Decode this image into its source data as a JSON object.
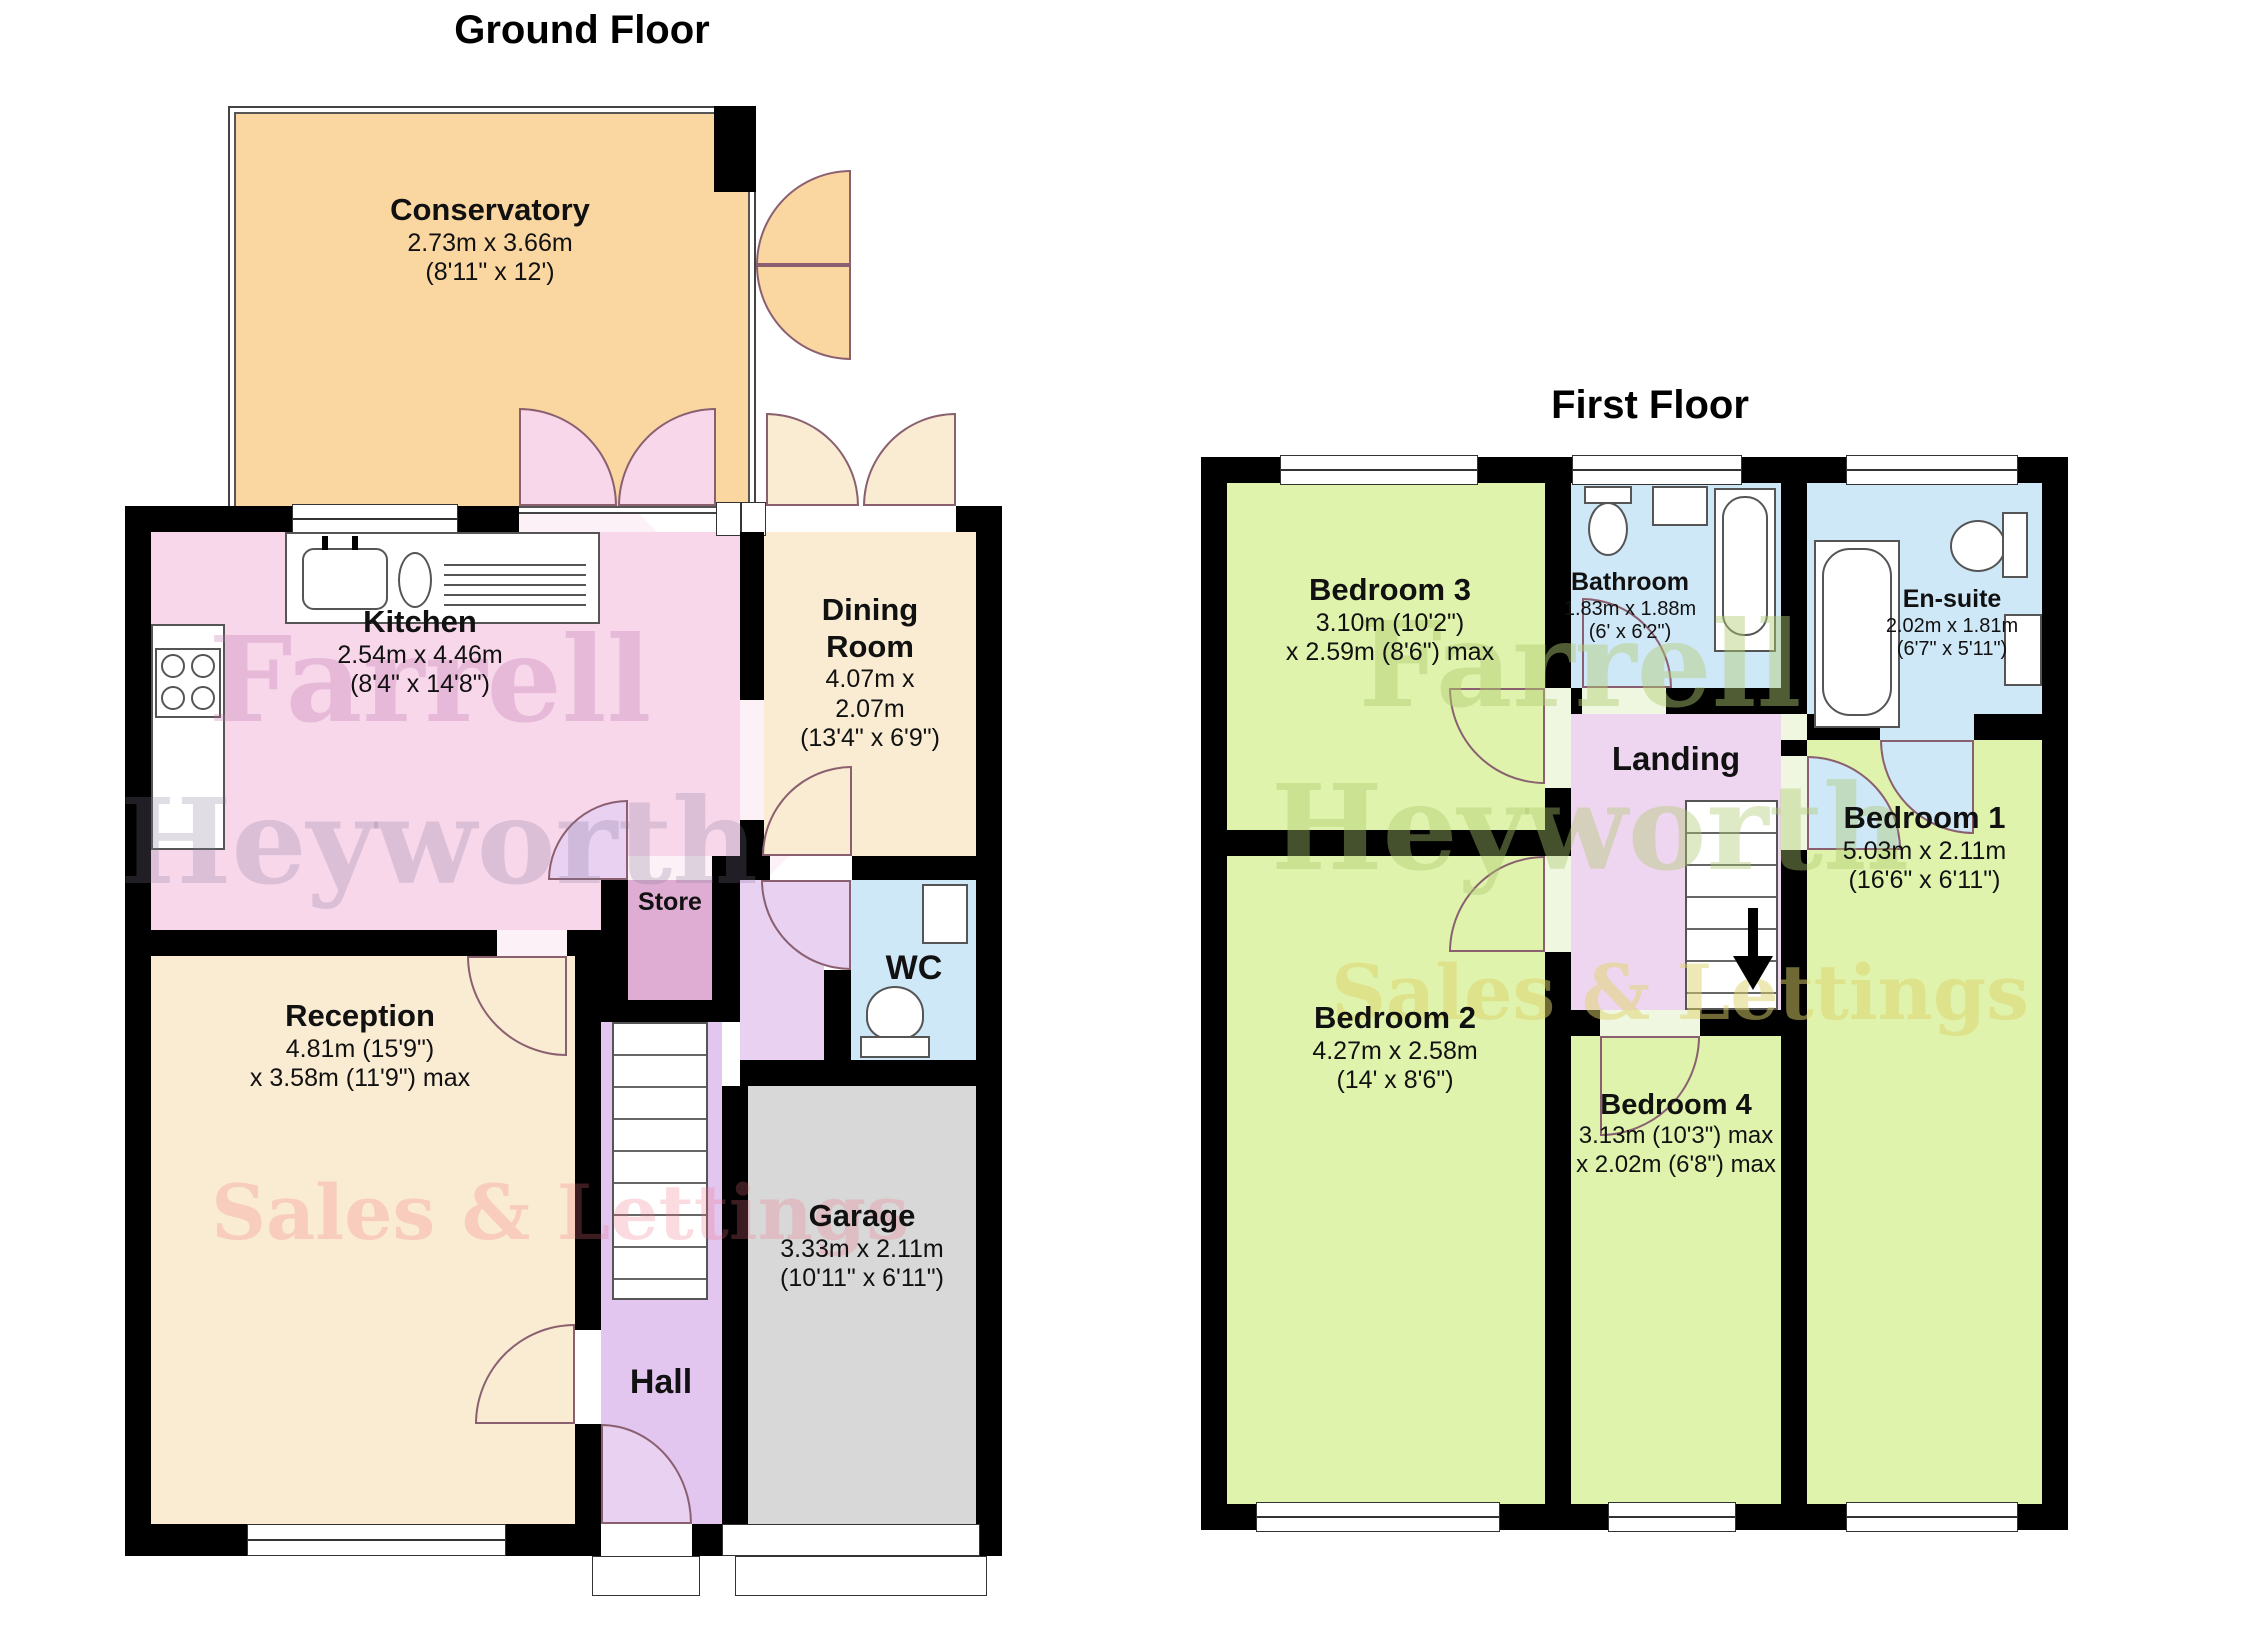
{
  "ground": {
    "title": "Ground Floor",
    "conservatory": {
      "name": "Conservatory",
      "d1": "2.73m x 3.66m",
      "d2": "(8'11\" x 12')"
    },
    "kitchen": {
      "name": "Kitchen",
      "d1": "2.54m x 4.46m",
      "d2": "(8'4\" x 14'8\")"
    },
    "dining": {
      "name": "Dining Room",
      "d1": "4.07m x 2.07m",
      "d2": "(13'4\" x 6'9\")"
    },
    "reception": {
      "name": "Reception",
      "d1": "4.81m (15'9\")",
      "d2": "x 3.58m (11'9\") max"
    },
    "store": {
      "name": "Store"
    },
    "wc": {
      "name": "WC"
    },
    "garage": {
      "name": "Garage",
      "d1": "3.33m x 2.11m",
      "d2": "(10'11\" x 6'11\")"
    },
    "hall": {
      "name": "Hall"
    }
  },
  "first": {
    "title": "First Floor",
    "bedroom3": {
      "name": "Bedroom 3",
      "d1": "3.10m (10'2\")",
      "d2": "x 2.59m (8'6\") max"
    },
    "bathroom": {
      "name": "Bathroom",
      "d1": "1.83m x 1.88m",
      "d2": "(6' x 6'2\")"
    },
    "ensuite": {
      "name": "En-suite",
      "d1": "2.02m x 1.81m",
      "d2": "(6'7\" x 5'11\")"
    },
    "bedroom1": {
      "name": "Bedroom 1",
      "d1": "5.03m x 2.11m",
      "d2": "(16'6\" x 6'11\")"
    },
    "landing": {
      "name": "Landing"
    },
    "bedroom2": {
      "name": "Bedroom 2",
      "d1": "4.27m x 2.58m",
      "d2": "(14' x 8'6\")"
    },
    "bedroom4": {
      "name": "Bedroom 4",
      "d1": "3.13m (10'3\") max",
      "d2": "x 2.02m (6'8\") max"
    }
  },
  "watermark": {
    "l1": "Farrell",
    "l2": "Heyworth",
    "l3": "Sales & Lettings"
  },
  "colors": {
    "wall": "#000000",
    "conservatory_peach": "#FAD7A1",
    "cream": "#FAECD2",
    "kitchen_pink": "#F8D7EB",
    "store_mauve": "#DFADD3",
    "hall_purple": "#E2C6F0",
    "bath_blue": "#CFE8F7",
    "garage_grey": "#D8D8D8",
    "bedroom_green": "#DFF3AC",
    "landing_pink": "#EED6F0"
  }
}
